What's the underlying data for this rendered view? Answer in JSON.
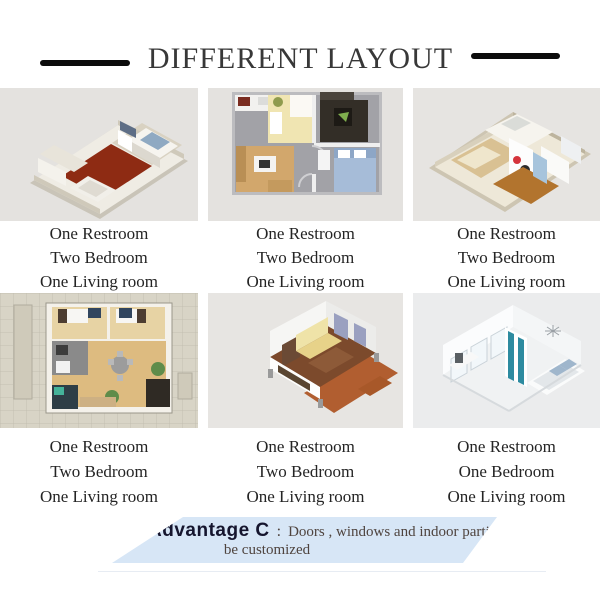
{
  "header": {
    "title": "DIFFERENT LAYOUT"
  },
  "cells": [
    {
      "image": "isometric-apartment-red-floor",
      "captions": [
        "One Restroom",
        "Two Bedroom",
        "One Living room"
      ]
    },
    {
      "image": "top-down-2d-floor-plan",
      "captions": [
        "One Restroom",
        "Two Bedroom",
        "One Living room"
      ]
    },
    {
      "image": "isometric-apartment-kids-room",
      "captions": [
        "One Restroom",
        "Two Bedroom",
        "One Living room"
      ]
    },
    {
      "image": "top-down-plan-tiled-patio",
      "captions": [
        "One Restroom",
        "Two Bedroom",
        "One Living room"
      ]
    },
    {
      "image": "isometric-module-with-deck",
      "captions": [
        "One Restroom",
        "Two Bedroom",
        "One Living room"
      ]
    },
    {
      "image": "isometric-white-bedroom",
      "captions": [
        "One Restroom",
        "One Bedroom",
        "One Living room"
      ]
    }
  ],
  "advantage": {
    "label": "Advantage C",
    "colon": ":",
    "line1": "Doors , windows and indoor partition  can",
    "line2": "be customized"
  },
  "colors": {
    "banner_background": "#d7e6f6",
    "title_text": "#383838",
    "title_line": "#0c0c0c",
    "caption_text": "#242424",
    "advantage_label": "#15152e",
    "advantage_text": "#4f443f",
    "cell_background": "#e4e2df"
  }
}
